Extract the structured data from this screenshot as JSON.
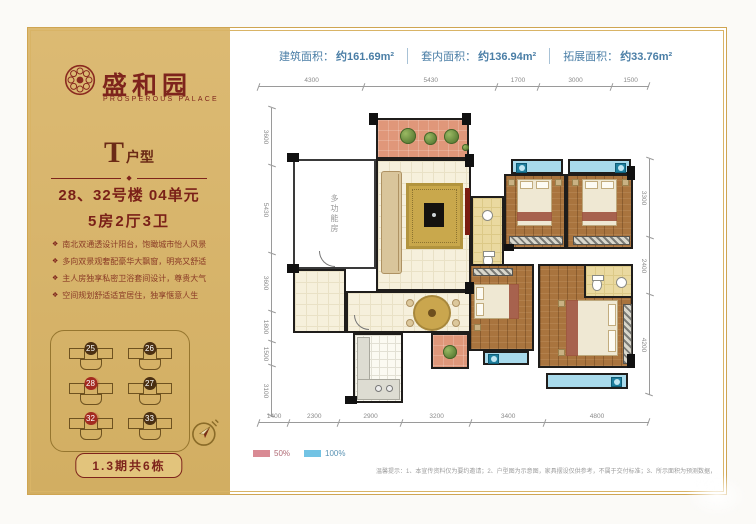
{
  "brand": {
    "name": "盛和园",
    "name_en": "PROSPEROUS PALACE"
  },
  "sidebar": {
    "unit_type_letter": "T",
    "unit_type_suffix": "户型",
    "divider_icon": "◆",
    "building_line": "28、32号楼  04单元",
    "layout_line": "5房2厅3卫",
    "bullet_icon": "❖",
    "features": [
      "南北双通透设计阳台，饱瞰城市怡人风景",
      "多向双景观奢配豪华大飘窗，明亮又舒适",
      "主人房独享私密卫浴套间设计，尊贵大气",
      "空间规划舒适适宜居住，独享惬意人生"
    ],
    "site_map": {
      "buildings": [
        {
          "num": "25",
          "state": ""
        },
        {
          "num": "26",
          "state": ""
        },
        {
          "num": "28",
          "state": "hl"
        },
        {
          "num": "27",
          "state": ""
        },
        {
          "num": "32",
          "state": "hl"
        },
        {
          "num": "33",
          "state": ""
        }
      ]
    },
    "compass_icon": "compass",
    "phase_button": "1.3期共6栋"
  },
  "banner": {
    "segments": [
      {
        "label": "建筑面积：",
        "value": "约161.69m²"
      },
      {
        "label": "套内面积：",
        "value": "约136.94m²"
      },
      {
        "label": "拓展面积：",
        "value": "约33.76m²"
      }
    ]
  },
  "plan": {
    "room_label_multifunction": "多功能房",
    "dims": {
      "top": [
        {
          "v": "4300"
        },
        {
          "v": "5430"
        },
        {
          "v": "1700"
        },
        {
          "v": "3000"
        },
        {
          "v": "1500"
        }
      ],
      "bottom": [
        {
          "v": "1400"
        },
        {
          "v": "2300"
        },
        {
          "v": "2900"
        },
        {
          "v": "3200"
        },
        {
          "v": "3400"
        },
        {
          "v": "4800"
        }
      ],
      "left": [
        {
          "v": "3600"
        },
        {
          "v": "5430"
        },
        {
          "v": "3600"
        },
        {
          "v": "1800"
        },
        {
          "v": "1500"
        },
        {
          "v": "3100"
        }
      ],
      "right": [
        {
          "v": "3300"
        },
        {
          "v": "2400"
        },
        {
          "v": "4200"
        }
      ]
    }
  },
  "legend": {
    "items": [
      {
        "label": "50%",
        "swatch": "pink"
      },
      {
        "label": "100%",
        "swatch": "cyan"
      }
    ]
  },
  "disclaimer": "温馨提示：1、本宣传资料仅为要约邀请；2、户型图为示意图，家具摆设仅供参考，不属于交付标准；3、所示面积为预测数据，最终以政府核准面积及购房合同约定为准；4、本公司保留最终解释权。",
  "colors": {
    "sidebar_gold": "#d5b269",
    "maroon": "#7e241c",
    "banner_blue": "#4a7ea6",
    "terrace_pink": "#e0977a",
    "legend_pink": "#d98a94",
    "balcony_cyan": "#a8daeb",
    "wood_floor": "#a9743e",
    "bath_tan": "#ead9a0"
  }
}
